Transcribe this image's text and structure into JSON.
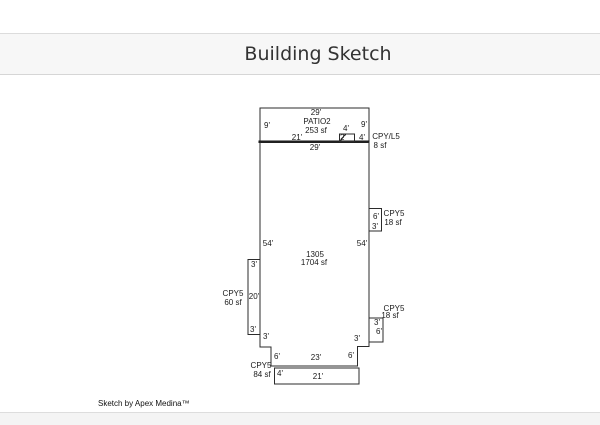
{
  "header": {
    "title": "Building Sketch"
  },
  "footer": {
    "credit": "Sketch by Apex Medina™"
  },
  "colors": {
    "line": "#2b2b2b",
    "thick_wall": "#151515",
    "header_bg": "#f7f7f7",
    "title_text": "#333333"
  },
  "sketch": {
    "areas": {
      "patio": {
        "name": "PATIO2",
        "sf": "253 sf"
      },
      "main": {
        "name": "1305",
        "sf": "1704 sf"
      },
      "cpy_l5": {
        "name": "CPY/L5",
        "sf": "8 sf"
      },
      "cpy5_right_upper": {
        "name": "CPY5",
        "sf": "18 sf"
      },
      "cpy5_right_lower": {
        "name": "CPY5",
        "sf": "18 sf"
      },
      "cpy5_left": {
        "name": "CPY5",
        "sf": "60 sf"
      },
      "cpy5_bottom": {
        "name": "CPY5",
        "sf": "84 sf"
      }
    },
    "labels": {
      "patio_top": "29'",
      "patio_left": "9'",
      "patio_name": "PATIO2",
      "patio_sf": "253 sf",
      "patio_right": "9'",
      "patio_bottom_left": "21'",
      "box_top": "4'",
      "box_inner": "2'",
      "box_right": "4'",
      "cpyl5_name": "CPY/L5",
      "cpyl5_sf": "8 sf",
      "main_top": "29'",
      "ru_height": "6'",
      "ru_width": "3'",
      "ru_name": "CPY5",
      "ru_sf": "18 sf",
      "left_54": "54'",
      "right_54": "54'",
      "main_name": "1305",
      "main_sf": "1704 sf",
      "lc_top": "3'",
      "lc_mid": "20'",
      "lc_bot": "3'",
      "lc_name": "CPY5",
      "lc_sf": "60 sf",
      "bl_step": "3'",
      "rl_width": "3'",
      "rl_height": "6'",
      "rl_name": "CPY5",
      "rl_sf": "18 sf",
      "br_step": "3'",
      "bottom_left_6": "6'",
      "bottom_23": "23'",
      "bottom_right_6": "6'",
      "bc_height": "4'",
      "bc_width": "21'",
      "bc_name": "CPY5",
      "bc_sf": "84 sf"
    }
  }
}
